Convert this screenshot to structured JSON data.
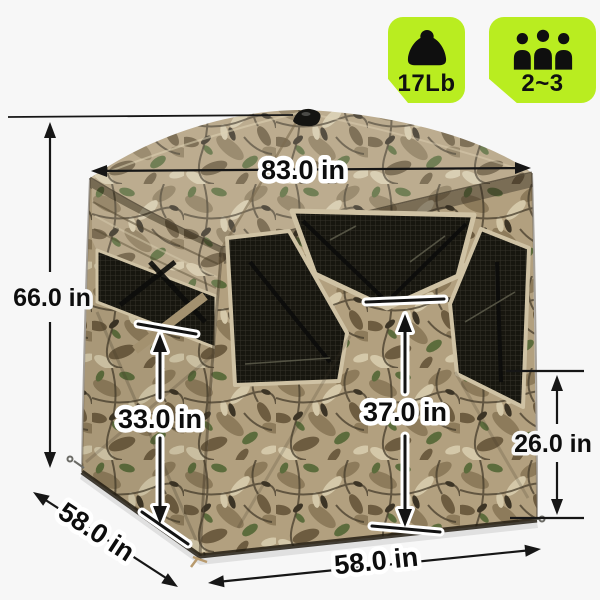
{
  "colors": {
    "background": "#f7f7f7",
    "badge_green": "#b9ed20",
    "badge_ink": "#101010",
    "annotation_ink": "#161616"
  },
  "badges": {
    "items": [
      {
        "icon": "weight-icon",
        "label": "17Lb"
      },
      {
        "icon": "people-icon",
        "label": "2~3"
      }
    ]
  },
  "dimensions": {
    "top_width": "83.0 in",
    "total_height": "66.0 in",
    "left_window_height": "33.0 in",
    "front_window_height": "37.0 in",
    "side_window_height": "26.0 in",
    "side_depth": "58.0 in",
    "front_width": "58.0 in"
  }
}
